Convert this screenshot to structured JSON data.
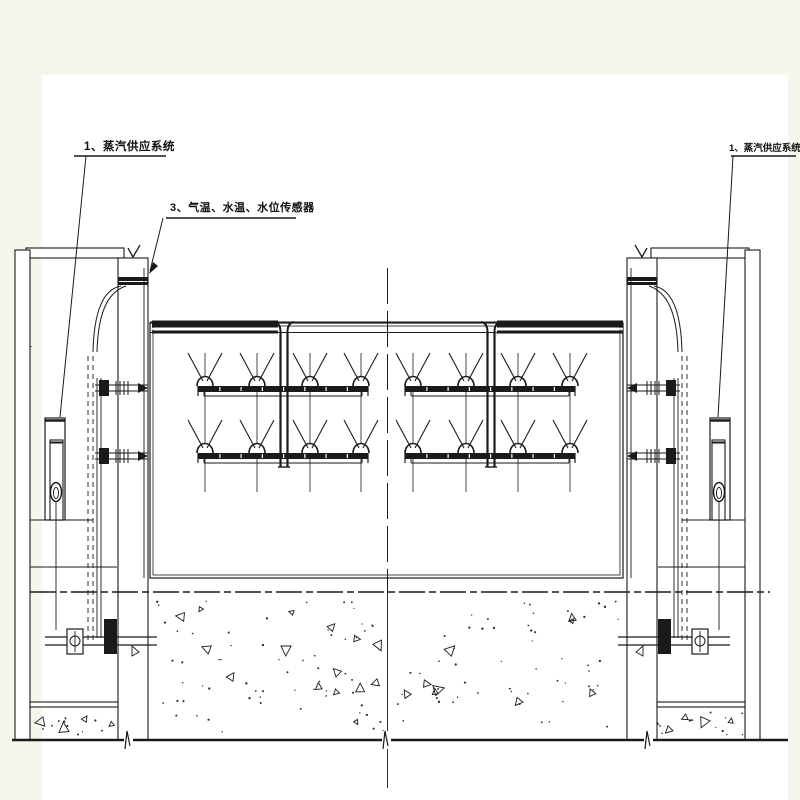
{
  "page": {
    "margin_color": "#f5f7ed",
    "paper_color": "#ffffff",
    "ink_color": "#1a1a1a"
  },
  "annotations": {
    "steam_system_left": {
      "label": "1、蒸汽供应系统"
    },
    "sensors": {
      "label": "3、气温、水温、水位传感器"
    },
    "steam_system_right": {
      "label": "1、蒸汽供应系统"
    }
  },
  "diagram": {
    "type": "engineering-section-drawing",
    "rows": 2,
    "nozzles_per_row": 8,
    "nozzle_columns_x": [
      205,
      257,
      310,
      361,
      413,
      466,
      518,
      570
    ],
    "spray_row_y": [
      386,
      453
    ],
    "spray_segments_x": [
      [
        198,
        368
      ],
      [
        405,
        575
      ]
    ],
    "drop_pipe_x": [
      284,
      491
    ],
    "center_line_x": 387.5,
    "datum_line_y": 592,
    "ground_line_y": 740
  }
}
